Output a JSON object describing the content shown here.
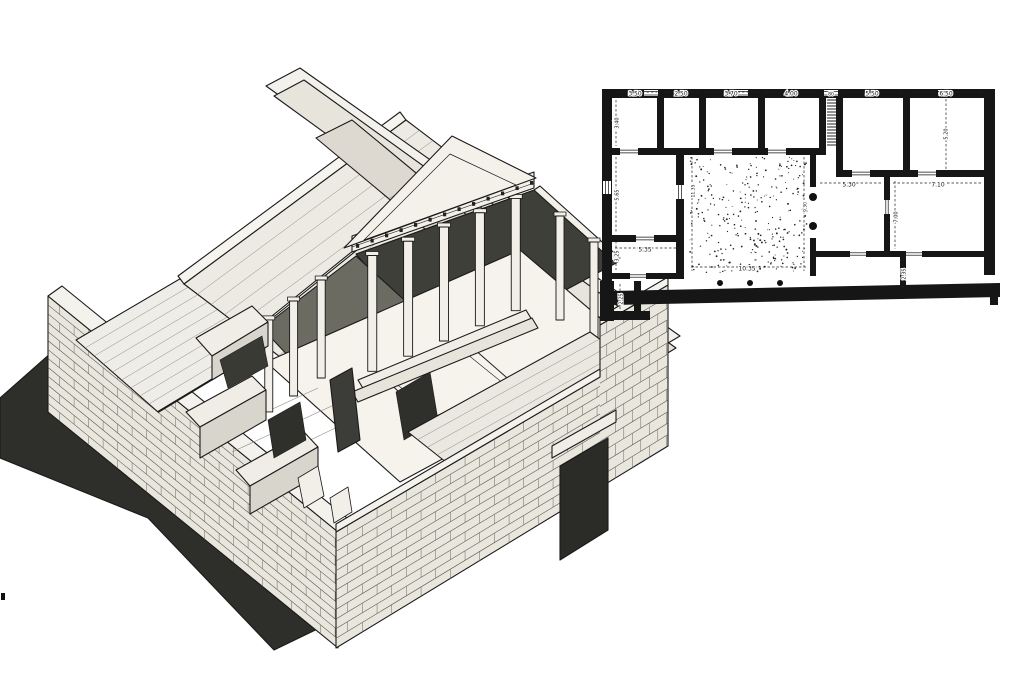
{
  "figure": {
    "kind": "scanned archaeological illustration",
    "colors": {
      "paper": "#ffffff",
      "ink": "#1a1a1a",
      "wall_black": "#161616",
      "shadow_dark": "#2e2e2a",
      "stone_light": "#eceae3",
      "interior_dark": "#3f3f39"
    },
    "parts": {
      "left": "axonometric cutaway reconstruction drawing of an atrium house",
      "right": "measured floor plan with dimension figures (metres)"
    }
  },
  "plan": {
    "courtyard_width_label": "10.35",
    "dimension_labels": [
      {
        "text": "3.50",
        "x": 35,
        "y": 9,
        "rot": 0,
        "size": 6,
        "line": [
          15,
          7,
          57,
          7
        ]
      },
      {
        "text": "2.50",
        "x": 81,
        "y": 9,
        "rot": 0,
        "size": 6,
        "line": [
          64,
          7,
          98,
          7
        ]
      },
      {
        "text": "3.70",
        "x": 131,
        "y": 9,
        "rot": 0,
        "size": 6,
        "line": [
          106,
          7,
          157,
          7
        ]
      },
      {
        "text": "4.00",
        "x": 191,
        "y": 9,
        "rot": 0,
        "size": 6,
        "line": [
          165,
          7,
          218,
          7
        ]
      },
      {
        "text": "80",
        "x": 231,
        "y": 9,
        "rot": 0,
        "size": 4.5,
        "line": null
      },
      {
        "text": "5.50",
        "x": 272,
        "y": 9,
        "rot": 0,
        "size": 6,
        "line": [
          244,
          7,
          302,
          7
        ]
      },
      {
        "text": "6.50",
        "x": 346,
        "y": 9,
        "rot": 0,
        "size": 6,
        "line": [
          311,
          7,
          383,
          7
        ]
      },
      {
        "text": "3.40",
        "x": 17,
        "y": 38,
        "rot": -90,
        "size": 5,
        "line": [
          16,
          15,
          16,
          61
        ]
      },
      {
        "text": "5.20",
        "x": 346,
        "y": 49,
        "rot": -90,
        "size": 5,
        "line": [
          346,
          14,
          346,
          84
        ]
      },
      {
        "text": "5.65",
        "x": 17,
        "y": 110,
        "rot": -90,
        "size": 5,
        "line": [
          16,
          72,
          16,
          148
        ]
      },
      {
        "text": "11.35",
        "x": 93,
        "y": 106,
        "rot": -90,
        "size": 4.5,
        "line": [
          92,
          72,
          92,
          186
        ]
      },
      {
        "text": "9.30",
        "x": 205,
        "y": 122,
        "rot": -90,
        "size": 4.5,
        "line": [
          204,
          72,
          204,
          186
        ]
      },
      {
        "text": "5.30",
        "x": 249,
        "y": 100,
        "rot": 0,
        "size": 6,
        "line": [
          220,
          98,
          281,
          98
        ]
      },
      {
        "text": "7.10",
        "x": 338,
        "y": 100,
        "rot": 0,
        "size": 6,
        "line": [
          293,
          98,
          382,
          98
        ]
      },
      {
        "text": "7.00",
        "x": 296,
        "y": 132,
        "rot": -90,
        "size": 5,
        "line": [
          295,
          96,
          295,
          164
        ]
      },
      {
        "text": "3.25",
        "x": 17,
        "y": 171,
        "rot": -90,
        "size": 5,
        "line": [
          16,
          156,
          16,
          185
        ]
      },
      {
        "text": "5.35",
        "x": 45,
        "y": 165,
        "rot": 0,
        "size": 6,
        "line": [
          15,
          163,
          80,
          163
        ]
      },
      {
        "text": "10.35",
        "x": 147,
        "y": 184,
        "rot": 0,
        "size": 6,
        "line": [
          91,
          182,
          207,
          182
        ]
      },
      {
        "text": "2.25",
        "x": 21,
        "y": 214,
        "rot": -90,
        "size": 5,
        "line": [
          20,
          199,
          20,
          231
        ]
      },
      {
        "text": "2.35",
        "x": 304,
        "y": 189,
        "rot": -90,
        "size": 5,
        "line": [
          303,
          174,
          303,
          203
        ]
      }
    ]
  }
}
